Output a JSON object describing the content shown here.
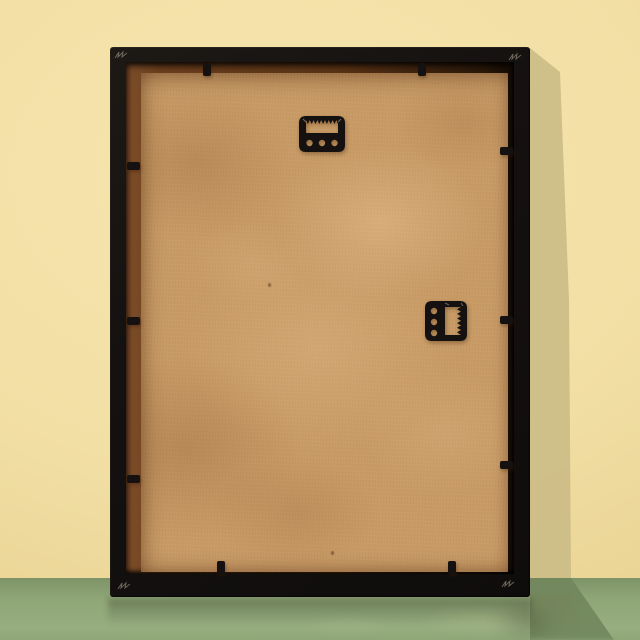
{
  "scene": {
    "description": "Rear view of a black picture frame with a kraft hardboard backing board, leaning against a pale yellow wall on a glossy sage-green floor; soft light from the upper left casts a shadow to the right of the frame.",
    "colors": {
      "wall": "#f2dfa4",
      "wall_bright": "#f7e5b0",
      "wall_edge": "#e7d190",
      "wall_shadow": "#cdbd87",
      "floor": "#8fa677",
      "floor_light": "#97ae80",
      "floor_dark": "#7e9468",
      "floor_shadow": "#72875d",
      "frame_black": "#151210",
      "rabbet_light": "#7e4e29",
      "rabbet_mid": "#5a3315",
      "rabbet_dark": "#140b04",
      "backing": "#c89b66",
      "backing_light": "#dab184",
      "backing_dark": "#a97b4d",
      "hardware_black": "#141110",
      "glint": "#a99f8c"
    },
    "horizon_y": 578
  },
  "frame": {
    "x": 110,
    "y": 47,
    "width": 420,
    "height": 550,
    "border": {
      "top": 15,
      "right": 16,
      "bottom": 23,
      "left": 16
    },
    "backing_inset": {
      "top": 26,
      "right": 22,
      "bottom": 25,
      "left": 31
    },
    "clips": [
      {
        "side": "top",
        "x": 93,
        "y": 16
      },
      {
        "side": "top",
        "x": 308,
        "y": 16
      },
      {
        "side": "left",
        "x": 17,
        "y": 115
      },
      {
        "side": "left",
        "x": 17,
        "y": 270
      },
      {
        "side": "left",
        "x": 17,
        "y": 428
      },
      {
        "side": "right",
        "x": 390,
        "y": 100
      },
      {
        "side": "right",
        "x": 390,
        "y": 269
      },
      {
        "side": "right",
        "x": 390,
        "y": 414
      },
      {
        "side": "bottom",
        "x": 107,
        "y": 514
      },
      {
        "side": "bottom",
        "x": 338,
        "y": 514
      }
    ],
    "corner_glints": [
      {
        "corner": "top-left",
        "x": 4,
        "y": 2
      },
      {
        "corner": "top-right",
        "x": 398,
        "y": 4
      },
      {
        "corner": "bottom-left",
        "x": 7,
        "y": 533
      },
      {
        "corner": "bottom-right",
        "x": 391,
        "y": 531
      }
    ],
    "backing_specks": [
      {
        "x": 190,
        "y": 478
      },
      {
        "x": 127,
        "y": 210
      }
    ]
  },
  "hangers": [
    {
      "id": "top",
      "type": "sawtooth",
      "orientation": "horizontal",
      "x": 189,
      "y": 69,
      "width": 46,
      "height": 36,
      "holes": 3
    },
    {
      "id": "right",
      "type": "sawtooth",
      "orientation": "vertical",
      "x": 315,
      "y": 254,
      "width": 42,
      "height": 40,
      "holes": 3
    }
  ],
  "shadows": {
    "wall": {
      "points": [
        [
          530,
          48
        ],
        [
          560,
          72
        ],
        [
          569,
          300
        ],
        [
          571,
          578
        ],
        [
          530,
          578
        ]
      ]
    },
    "floor": {
      "points": [
        [
          530,
          578
        ],
        [
          571,
          578
        ],
        [
          614,
          640
        ],
        [
          530,
          640
        ]
      ]
    }
  }
}
